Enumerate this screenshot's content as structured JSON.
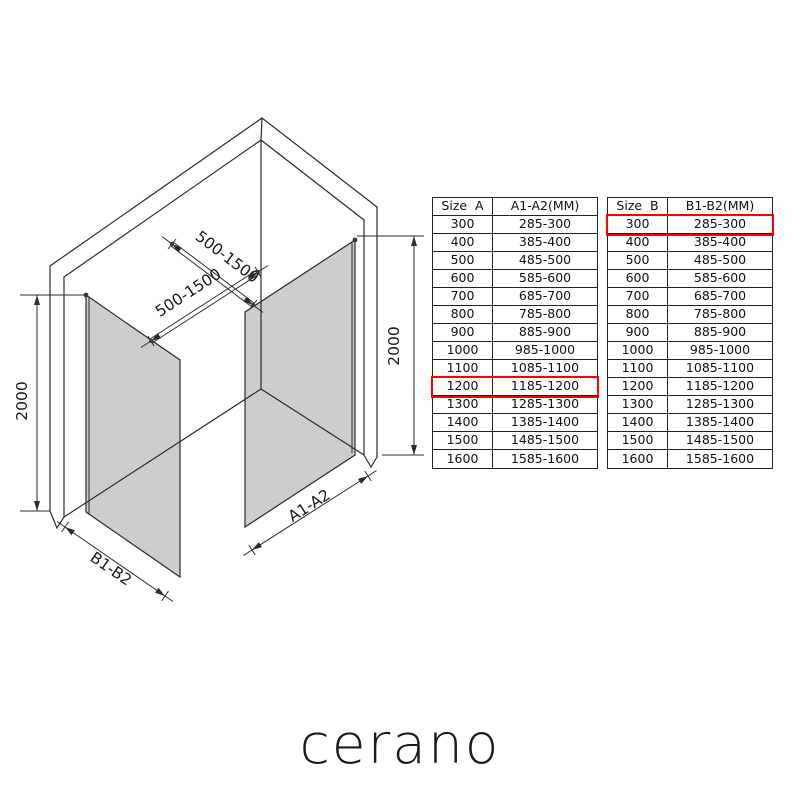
{
  "brand": {
    "logo": "cerano"
  },
  "diagram": {
    "labels": {
      "bar_length_top": "500-1500",
      "bar_length_bottom": "500-1500",
      "height_left": "2000",
      "height_right": "2000",
      "panel_a_width": "A1-A2",
      "panel_b_width": "B1-B2"
    },
    "colors": {
      "glass": "#cdcdcd",
      "line": "#2b2b2b",
      "highlight": "#ff0000"
    }
  },
  "tables": [
    {
      "id": "size-a",
      "columns": [
        "Size  A",
        "A1-A2(MM)"
      ],
      "highlight_row": "1200",
      "rows": [
        [
          "300",
          "285-300"
        ],
        [
          "400",
          "385-400"
        ],
        [
          "500",
          "485-500"
        ],
        [
          "600",
          "585-600"
        ],
        [
          "700",
          "685-700"
        ],
        [
          "800",
          "785-800"
        ],
        [
          "900",
          "885-900"
        ],
        [
          "1000",
          "985-1000"
        ],
        [
          "1100",
          "1085-1100"
        ],
        [
          "1200",
          "1185-1200"
        ],
        [
          "1300",
          "1285-1300"
        ],
        [
          "1400",
          "1385-1400"
        ],
        [
          "1500",
          "1485-1500"
        ],
        [
          "1600",
          "1585-1600"
        ]
      ]
    },
    {
      "id": "size-b",
      "columns": [
        "Size  B",
        "B1-B2(MM)"
      ],
      "highlight_row": "300",
      "rows": [
        [
          "300",
          "285-300"
        ],
        [
          "400",
          "385-400"
        ],
        [
          "500",
          "485-500"
        ],
        [
          "600",
          "585-600"
        ],
        [
          "700",
          "685-700"
        ],
        [
          "800",
          "785-800"
        ],
        [
          "900",
          "885-900"
        ],
        [
          "1000",
          "985-1000"
        ],
        [
          "1100",
          "1085-1100"
        ],
        [
          "1200",
          "1185-1200"
        ],
        [
          "1300",
          "1285-1300"
        ],
        [
          "1400",
          "1385-1400"
        ],
        [
          "1500",
          "1485-1500"
        ],
        [
          "1600",
          "1585-1600"
        ]
      ]
    }
  ]
}
